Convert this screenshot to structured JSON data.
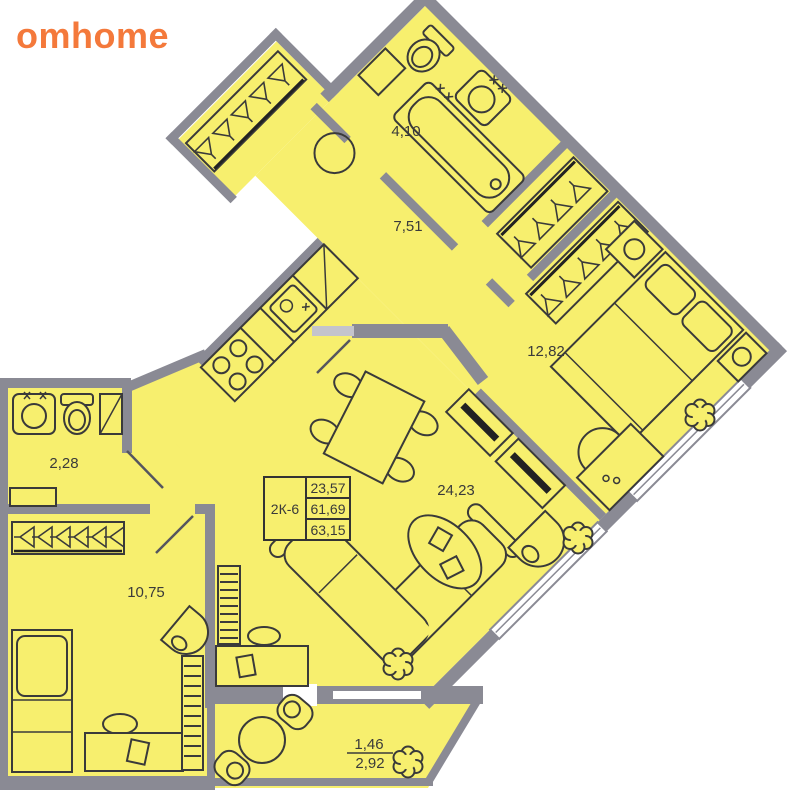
{
  "logo": {
    "text": "omhome",
    "color": "#F4793B"
  },
  "plan": {
    "rooms": {
      "bathroom": "4,10",
      "hallway": "7,51",
      "bedroom": "12,82",
      "wc": "2,28",
      "living_kitchen": "24,23",
      "bedroom2": "10,75"
    },
    "balcony": {
      "reduced": "1,46",
      "full": "2,92"
    },
    "info_box": {
      "unit": "2К-6",
      "rows": [
        "23,57",
        "61,69",
        "63,15"
      ]
    },
    "colors": {
      "floor": "#F7EF6E",
      "walls": "#8A8A94",
      "lines": "#3A3A3A",
      "accent": "#F4793B"
    }
  }
}
